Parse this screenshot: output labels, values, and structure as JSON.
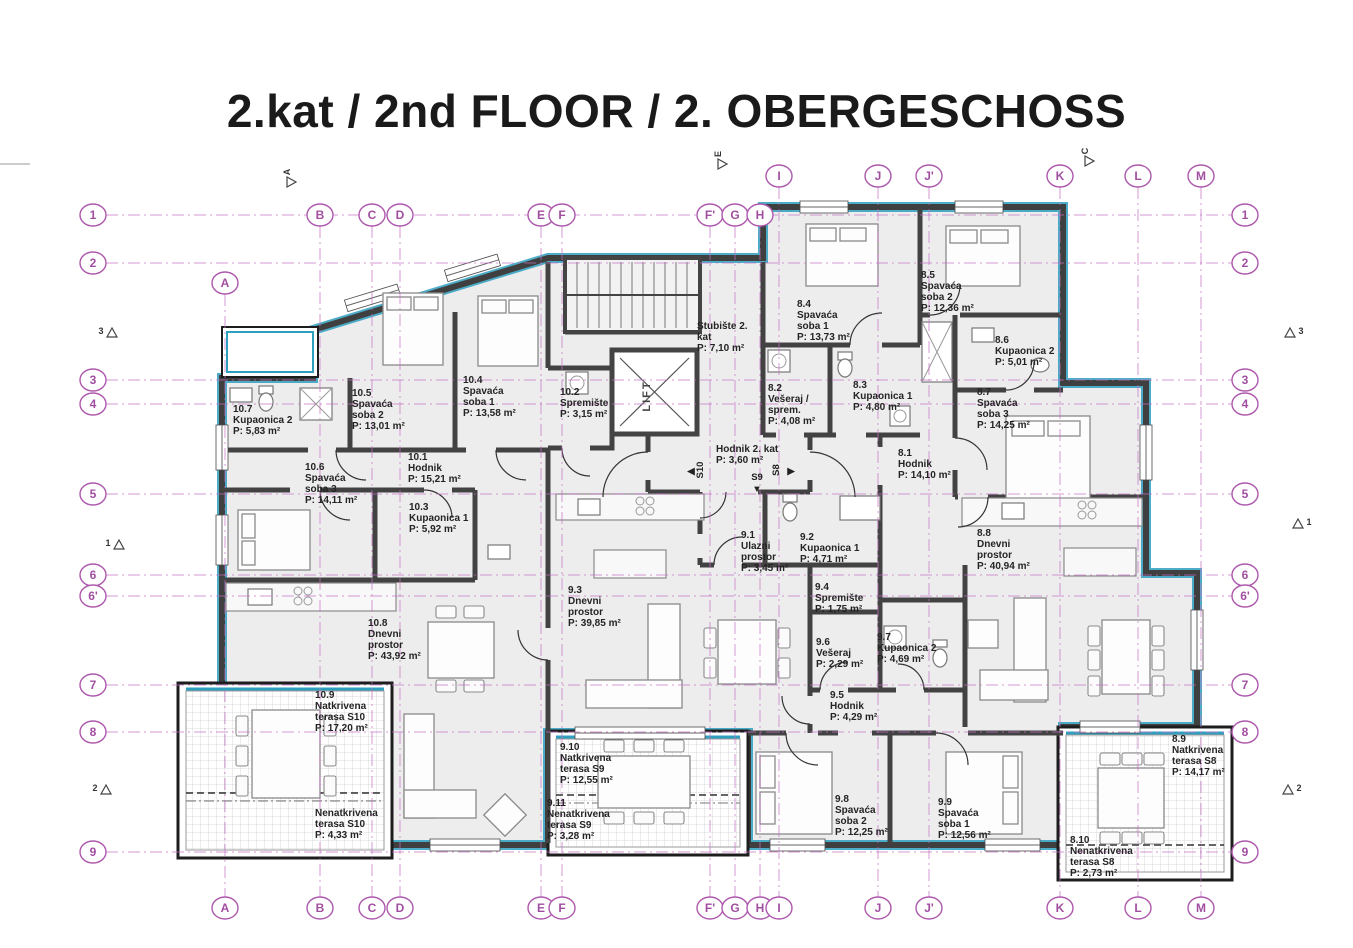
{
  "title": "2.kat / 2nd FLOOR / 2. OBERGESCHOSS",
  "colors": {
    "grid_magenta": "#ad58ad",
    "grid_line": "#c36fc3",
    "teal_accent": "#2e9fbe",
    "wall_dark": "#3f3f3f",
    "room_fill": "#ededed",
    "text_dark": "#242424"
  },
  "grid": {
    "bottom_y": 908,
    "row_x1": 93,
    "row_x2": 1245,
    "rows": [
      {
        "label": "1",
        "y": 215
      },
      {
        "label": "2",
        "y": 263
      },
      {
        "label": "3",
        "y": 380
      },
      {
        "label": "4",
        "y": 404
      },
      {
        "label": "5",
        "y": 494
      },
      {
        "label": "6",
        "y": 575
      },
      {
        "label": "6'",
        "y": 596
      },
      {
        "label": "7",
        "y": 685
      },
      {
        "label": "8",
        "y": 732
      },
      {
        "label": "9",
        "y": 852
      }
    ],
    "columns": [
      {
        "label": "A",
        "x": 225,
        "top_y": 283
      },
      {
        "label": "B",
        "x": 320,
        "top_y": 215
      },
      {
        "label": "C",
        "x": 372,
        "top_y": 215
      },
      {
        "label": "D",
        "x": 400,
        "top_y": 215
      },
      {
        "label": "E",
        "x": 541,
        "top_y": 215
      },
      {
        "label": "F",
        "x": 562,
        "top_y": 215
      },
      {
        "label": "F'",
        "x": 710,
        "top_y": 215
      },
      {
        "label": "G",
        "x": 735,
        "top_y": 215
      },
      {
        "label": "H",
        "x": 760,
        "top_y": 215
      },
      {
        "label": "I",
        "x": 779,
        "top_y": 176
      },
      {
        "label": "J",
        "x": 878,
        "top_y": 176
      },
      {
        "label": "J'",
        "x": 929,
        "top_y": 176
      },
      {
        "label": "K",
        "x": 1060,
        "top_y": 176
      },
      {
        "label": "L",
        "x": 1138,
        "top_y": 176
      },
      {
        "label": "M",
        "x": 1201,
        "top_y": 176
      }
    ]
  },
  "section_markers": [
    {
      "label": "3",
      "x": 112,
      "y": 334,
      "pos": "left"
    },
    {
      "label": "1",
      "x": 119,
      "y": 546,
      "pos": "left"
    },
    {
      "label": "2",
      "x": 106,
      "y": 791,
      "pos": "left"
    },
    {
      "label": "3",
      "x": 1290,
      "y": 334,
      "pos": "right"
    },
    {
      "label": "1",
      "x": 1298,
      "y": 525,
      "pos": "right"
    },
    {
      "label": "2",
      "x": 1288,
      "y": 791,
      "pos": "right"
    },
    {
      "label": "A",
      "x": 291,
      "y": 182,
      "pos": "top"
    },
    {
      "label": "E",
      "x": 722,
      "y": 164,
      "pos": "top"
    },
    {
      "label": "C",
      "x": 1089,
      "y": 161,
      "pos": "top"
    }
  ],
  "rooms": [
    {
      "lines": [
        "10.7",
        "Kupaonica 2",
        "P: 5,83 m²"
      ],
      "x": 233,
      "y": 412
    },
    {
      "lines": [
        "10.5",
        "Spavaća",
        "soba 2",
        "P: 13,01 m²"
      ],
      "x": 352,
      "y": 396
    },
    {
      "lines": [
        "10.4",
        "Spavaća",
        "soba 1",
        "P: 13,58 m²"
      ],
      "x": 463,
      "y": 383
    },
    {
      "lines": [
        "10.2",
        "Spremište",
        "P: 3,15 m²"
      ],
      "x": 560,
      "y": 395
    },
    {
      "lines": [
        "10.1",
        "Hodnik",
        "P: 15,21 m²"
      ],
      "x": 408,
      "y": 460
    },
    {
      "lines": [
        "10.6",
        "Spavaća",
        "soba 3",
        "P: 14,11 m²"
      ],
      "x": 305,
      "y": 470
    },
    {
      "lines": [
        "10.3",
        "Kupaonica 1",
        "P: 5,92 m²"
      ],
      "x": 409,
      "y": 510
    },
    {
      "lines": [
        "10.8",
        "Dnevni",
        "prostor",
        "P: 43,92 m²"
      ],
      "x": 368,
      "y": 626
    },
    {
      "lines": [
        "10.9",
        "Natkrivena",
        "terasa S10",
        "P: 17,20 m²"
      ],
      "x": 315,
      "y": 698
    },
    {
      "lines": [
        "Nenatkrivena",
        "terasa S10",
        "P: 4,33 m²"
      ],
      "x": 315,
      "y": 816
    },
    {
      "lines": [
        "Stubište 2.",
        "kat",
        "P: 7,10 m²"
      ],
      "x": 697,
      "y": 329
    },
    {
      "lines": [
        "Hodnik 2. kat",
        "P: 3,60 m²"
      ],
      "x": 716,
      "y": 452
    },
    {
      "lines": [
        "8.4",
        "Spavaća",
        "soba 1",
        "P: 13,73 m²"
      ],
      "x": 797,
      "y": 307
    },
    {
      "lines": [
        "8.5",
        "Spavaća",
        "soba 2",
        "P: 12,36 m²"
      ],
      "x": 921,
      "y": 278
    },
    {
      "lines": [
        "8.6",
        "Kupaonica 2",
        "P: 5,01 m²"
      ],
      "x": 995,
      "y": 343
    },
    {
      "lines": [
        "8.2",
        "Vešeraj /",
        "sprem.",
        "P: 4,08 m²"
      ],
      "x": 768,
      "y": 391
    },
    {
      "lines": [
        "8.3",
        "Kupaonica 1",
        "P: 4,80 m²"
      ],
      "x": 853,
      "y": 388
    },
    {
      "lines": [
        "8.7",
        "Spavaća",
        "soba 3",
        "P: 14,25 m²"
      ],
      "x": 977,
      "y": 395
    },
    {
      "lines": [
        "8.1",
        "Hodnik",
        "P: 14,10 m²"
      ],
      "x": 898,
      "y": 456
    },
    {
      "lines": [
        "8.8",
        "Dnevni",
        "prostor",
        "P: 40,94 m²"
      ],
      "x": 977,
      "y": 536
    },
    {
      "lines": [
        "9.1",
        "Ulazni",
        "prostor",
        "P: 3,45 m²"
      ],
      "x": 741,
      "y": 538
    },
    {
      "lines": [
        "9.2",
        "Kupaonica 1",
        "P: 4,71 m²"
      ],
      "x": 800,
      "y": 540
    },
    {
      "lines": [
        "9.3",
        "Dnevni",
        "prostor",
        "P: 39,85 m²"
      ],
      "x": 568,
      "y": 593
    },
    {
      "lines": [
        "9.4",
        "Spremište",
        "P: 1,75 m²"
      ],
      "x": 815,
      "y": 590
    },
    {
      "lines": [
        "9.6",
        "Vešeraj",
        "P: 2,29 m²"
      ],
      "x": 816,
      "y": 645
    },
    {
      "lines": [
        "9.7",
        "Kupaonica 2",
        "P: 4,69 m²"
      ],
      "x": 877,
      "y": 640
    },
    {
      "lines": [
        "9.5",
        "Hodnik",
        "P: 4,29 m²"
      ],
      "x": 830,
      "y": 698
    },
    {
      "lines": [
        "9.10",
        "Natkrivena",
        "terasa S9",
        "P: 12,55 m²"
      ],
      "x": 560,
      "y": 750
    },
    {
      "lines": [
        "9.11",
        "Nenatkrivena",
        "terasa S9",
        "P: 3,28 m²"
      ],
      "x": 547,
      "y": 806
    },
    {
      "lines": [
        "9.8",
        "Spavaća",
        "soba 2",
        "P: 12,25 m²"
      ],
      "x": 835,
      "y": 802
    },
    {
      "lines": [
        "9.9",
        "Spavaća",
        "soba 1",
        "P: 12,56 m²"
      ],
      "x": 938,
      "y": 805
    },
    {
      "lines": [
        "8.9",
        "Natkrivena",
        "terasa S8",
        "P: 14,17 m²"
      ],
      "x": 1172,
      "y": 742
    },
    {
      "lines": [
        "8.10",
        "Nenatkrivena",
        "terasa S8",
        "P: 2,73 m²"
      ],
      "x": 1070,
      "y": 843
    }
  ],
  "special_labels": [
    {
      "text": "LIFT",
      "x": 650,
      "y": 396,
      "rotate": -90,
      "cls": "lift"
    },
    {
      "text": "S10",
      "x": 703,
      "y": 470,
      "rotate": -90,
      "cls": "smark"
    },
    {
      "text": "◀",
      "x": 691,
      "y": 474,
      "rotate": 0,
      "cls": "smark"
    },
    {
      "text": "S9",
      "x": 757,
      "y": 480,
      "rotate": 0,
      "cls": "smark"
    },
    {
      "text": "▼",
      "x": 757,
      "y": 492,
      "rotate": 0,
      "cls": "smark"
    },
    {
      "text": "S8",
      "x": 779,
      "y": 470,
      "rotate": -90,
      "cls": "smark"
    },
    {
      "text": "▶",
      "x": 791,
      "y": 474,
      "rotate": 0,
      "cls": "smark"
    }
  ]
}
